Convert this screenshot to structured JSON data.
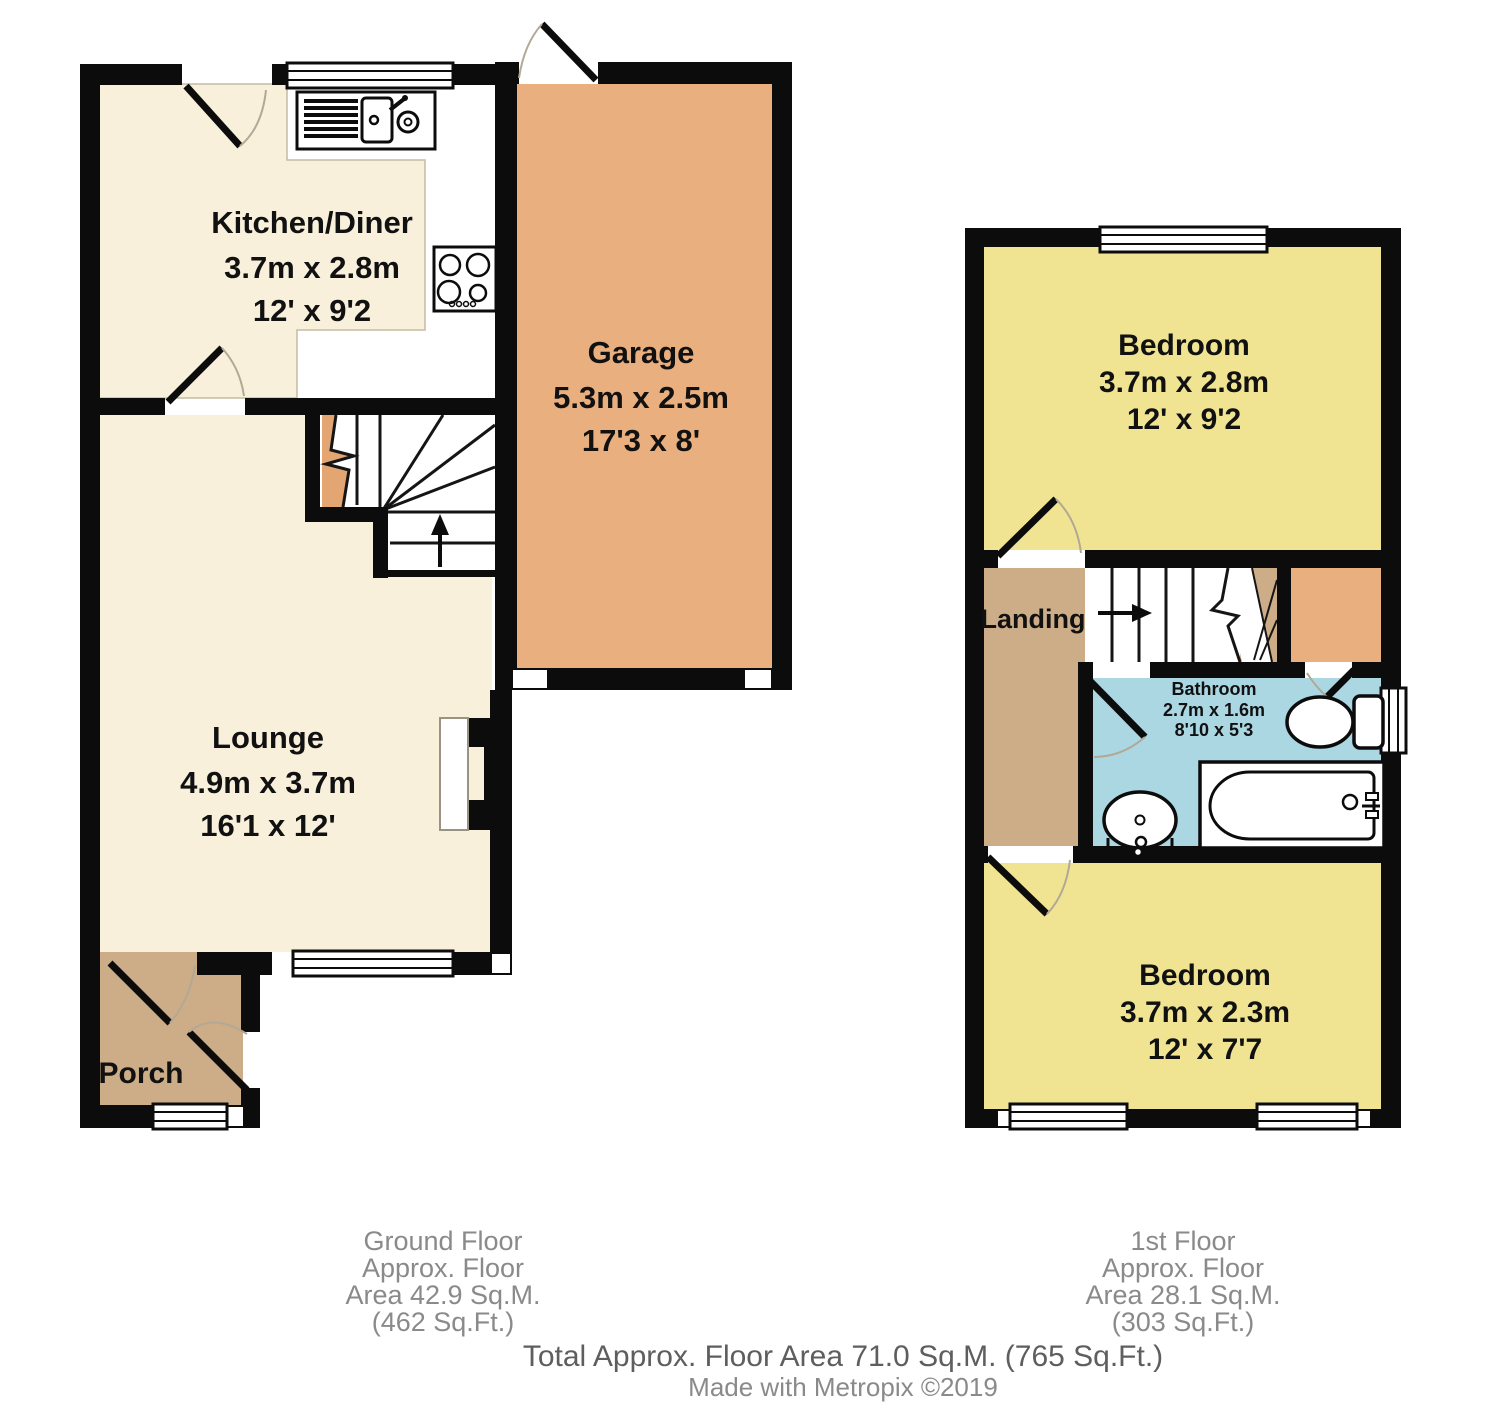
{
  "ground_floor": {
    "rooms": {
      "kitchen": {
        "name": "Kitchen/Diner",
        "metric": "3.7m x 2.8m",
        "imperial": "12' x 9'2"
      },
      "garage": {
        "name": "Garage",
        "metric": "5.3m x 2.5m",
        "imperial": "17'3 x 8'"
      },
      "lounge": {
        "name": "Lounge",
        "metric": "4.9m x 3.7m",
        "imperial": "16'1 x 12'"
      },
      "porch": {
        "name": "Porch"
      }
    },
    "footer": {
      "line1": "Ground Floor",
      "line2": "Approx. Floor",
      "line3": "Area 42.9 Sq.M.",
      "line4": "(462 Sq.Ft.)"
    }
  },
  "first_floor": {
    "rooms": {
      "bedroom1": {
        "name": "Bedroom",
        "metric": "3.7m x 2.8m",
        "imperial": "12' x 9'2"
      },
      "landing": {
        "name": "Landing"
      },
      "bathroom": {
        "name": "Bathroom",
        "metric": "2.7m x 1.6m",
        "imperial": "8'10 x 5'3"
      },
      "bedroom2": {
        "name": "Bedroom",
        "metric": "3.7m x 2.3m",
        "imperial": "12' x 7'7"
      }
    },
    "footer": {
      "line1": "1st Floor",
      "line2": "Approx. Floor",
      "line3": "Area 28.1 Sq.M.",
      "line4": "(303 Sq.Ft.)"
    }
  },
  "totals": {
    "total_line": "Total Approx. Floor Area 71.0 Sq.M. (765 Sq.Ft.)",
    "credit_line": "Made with Metropix ©2019"
  },
  "colors": {
    "wall": "#0c0c0c",
    "kitchen_lounge_floor": "#f8f0db",
    "garage_cupboard_floor": "#eaaf7e",
    "porch_landing_floor": "#cdad87",
    "bedroom_floor": "#f0e493",
    "bathroom_floor": "#abd7e3",
    "stair_break": "#e3a571",
    "footer_text": "#8a8a8a",
    "total_text": "#5e5e5e"
  }
}
